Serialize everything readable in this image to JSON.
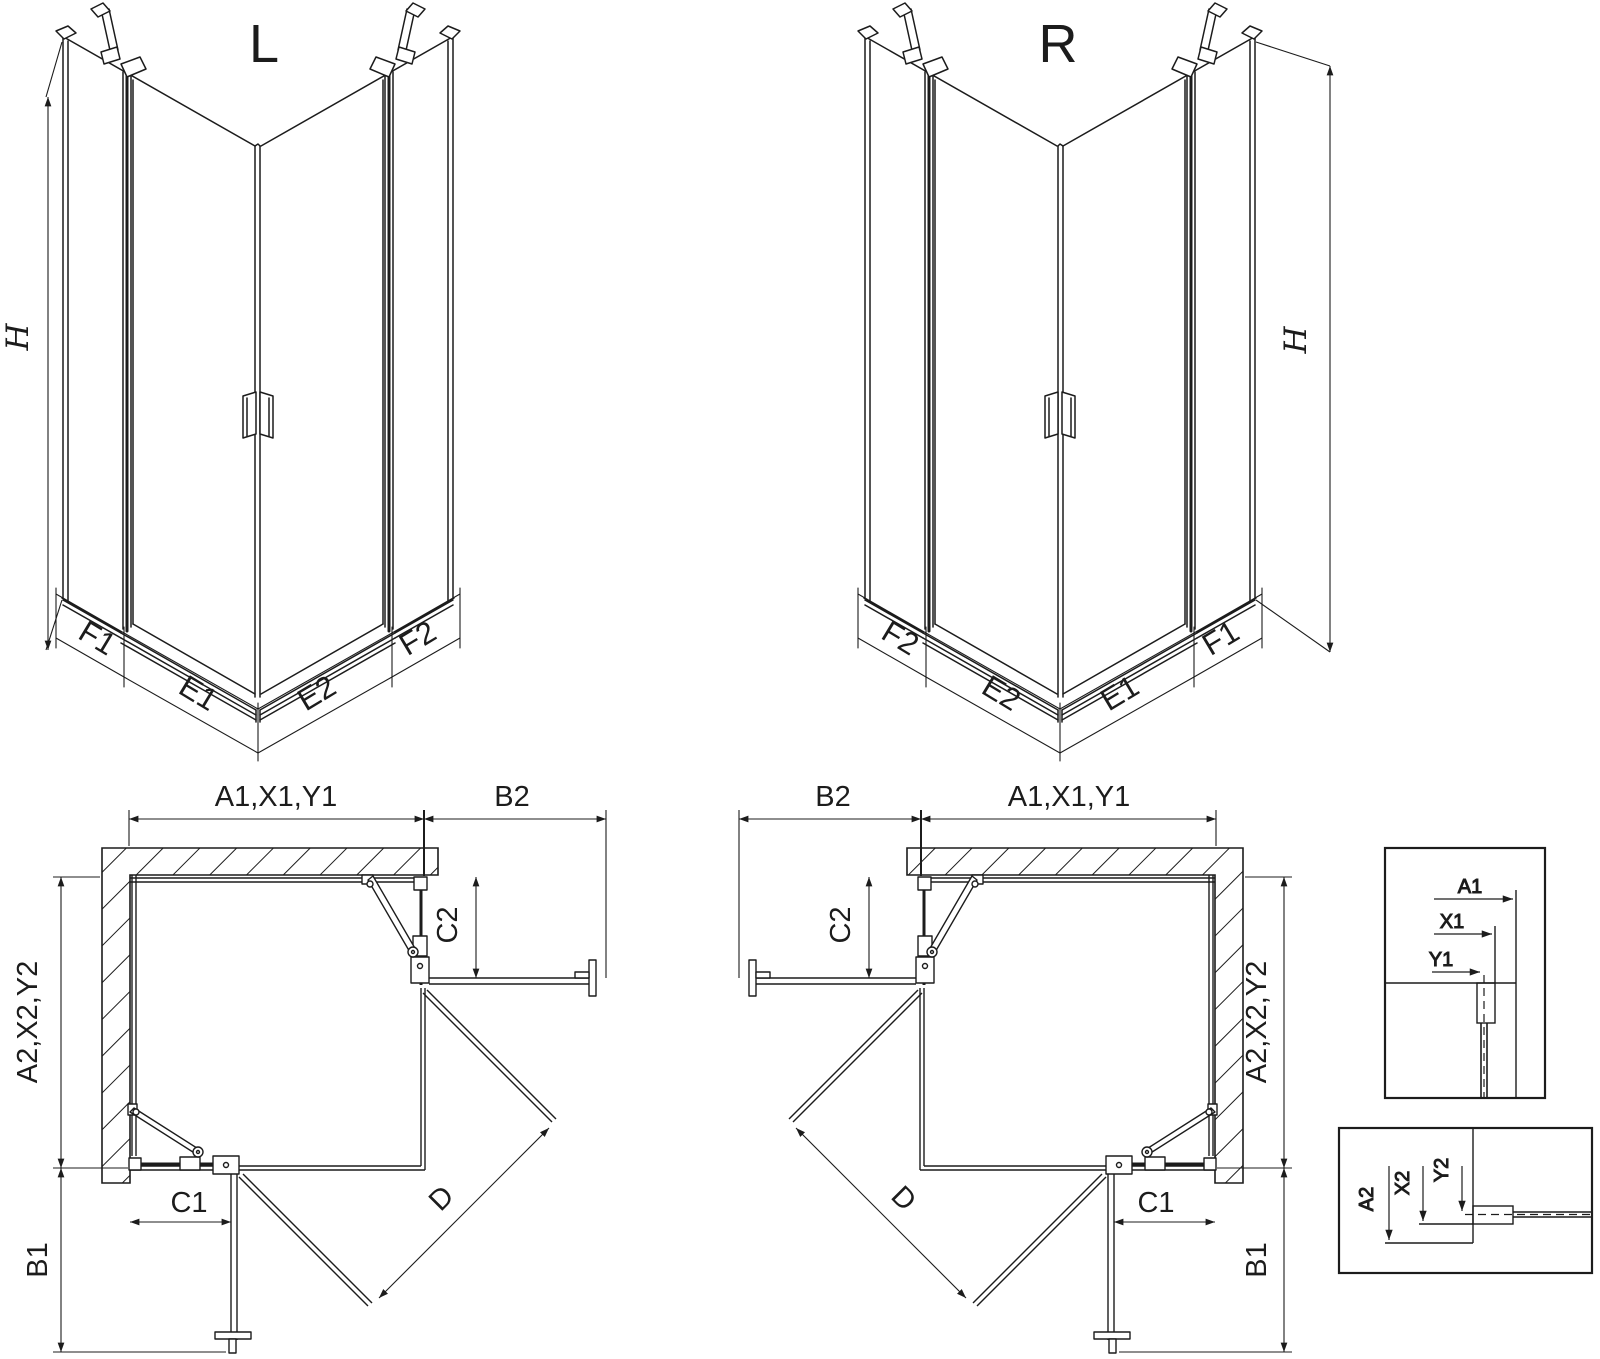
{
  "drawing": {
    "background": "#ffffff",
    "line_color": "#1c1c1c",
    "iso_left_view": {
      "title": "L",
      "height_label": "H",
      "segment_f1": "F1",
      "segment_e1": "E1",
      "segment_e2": "E2",
      "segment_f2": "F2"
    },
    "iso_right_view": {
      "title": "R",
      "height_label": "H",
      "segment_f2": "F2",
      "segment_e2": "E2",
      "segment_e1": "E1",
      "segment_f1": "F1"
    },
    "plan_left_view": {
      "top_width": "A1,X1,Y1",
      "side_panel_top": "B2",
      "door_top": "C2",
      "left_depth": "A2,X2,Y2",
      "side_panel_bottom": "B1",
      "door_bottom": "C1",
      "diagonal": "D"
    },
    "plan_right_view": {
      "top_width": "A1,X1,Y1",
      "side_panel_top": "B2",
      "door_top": "C2",
      "right_depth": "A2,X2,Y2",
      "side_panel_bottom": "B1",
      "door_bottom": "C1",
      "diagonal": "D"
    },
    "detail_top_view": {
      "a1": "A1",
      "x1": "X1",
      "y1": "Y1"
    },
    "detail_bottom_view": {
      "a2": "A2",
      "x2": "X2",
      "y2": "Y2"
    }
  }
}
